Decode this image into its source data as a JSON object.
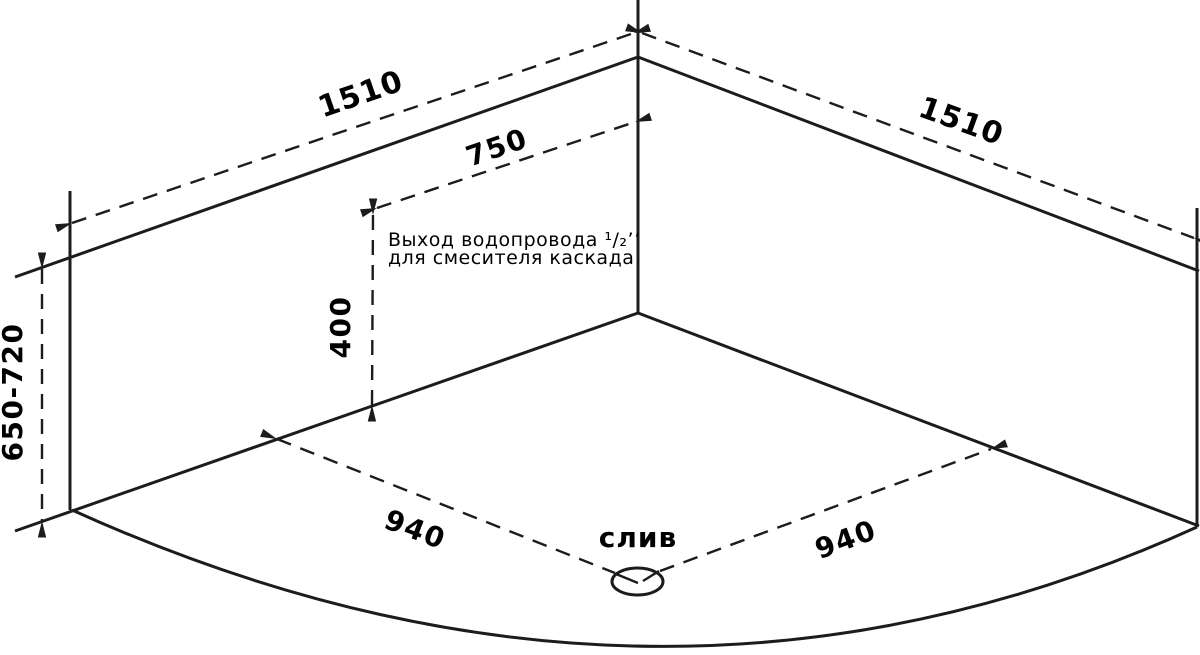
{
  "colors": {
    "background": "#ffffff",
    "line": "#1c1c1c",
    "text": "#000000"
  },
  "dimensions": {
    "top_left_edge": "1510",
    "top_right_edge": "1510",
    "outlet_offset": "750",
    "outlet_height": "400",
    "install_height": "650-720",
    "floor_left": "940",
    "floor_right": "940"
  },
  "labels": {
    "drain": "слив",
    "annotation_line1": "Выход водопровода ¹/₂’’",
    "annotation_line2": "для смесителя каскада"
  }
}
